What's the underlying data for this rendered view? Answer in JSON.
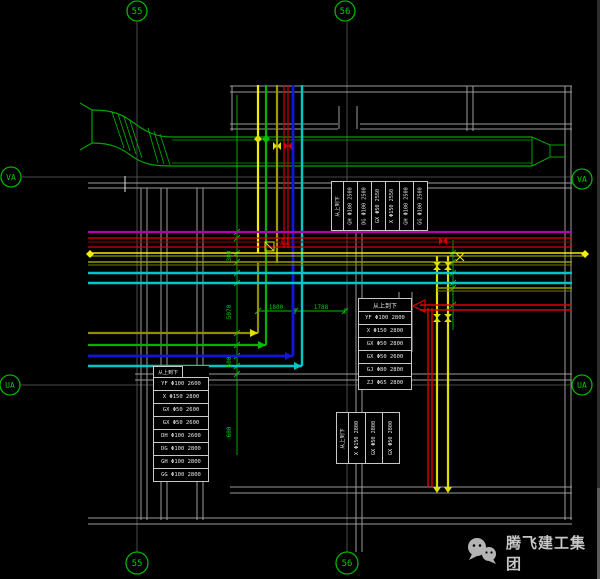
{
  "grid": {
    "col_a": "55",
    "col_b": "56",
    "row_a": "VA",
    "row_b": "UA"
  },
  "dims": {
    "h1": "1800",
    "h2": "1788",
    "v1": "5070",
    "v2": "300",
    "v3": "600",
    "v4": "600"
  },
  "tables": {
    "top_right": {
      "header": "从上到下",
      "cols": [
        "GH Φ100 2500",
        "DG Φ100 2500",
        "GX Φ50 2550",
        "X Φ150 2550",
        "GH Φ100 2500",
        "GG Φ100 2500"
      ]
    },
    "mid_right": {
      "header": "从上到下",
      "rows": [
        "YF Φ100 2800",
        "X Φ150 2800",
        "GX Φ50 2800",
        "GX Φ50 2600",
        "GJ Φ80 2800",
        "ZJ Φ65 2800"
      ]
    },
    "left": {
      "header": "从上到下",
      "rows": [
        "YF Φ100 2600",
        "X Φ150 2800",
        "GX Φ50 2600",
        "GX Φ50 2600",
        "DH Φ100 2600",
        "DG Φ100 2800",
        "GH Φ100 2800",
        "GG Φ100 2800"
      ]
    },
    "bottom_center": {
      "header": "从上到下",
      "cols": [
        "X Φ150 2800",
        "GX Φ50 2800",
        "GX Φ50 2800"
      ]
    }
  },
  "logo": {
    "text": "腾飞建工集团",
    "icon": "wechat-icon"
  },
  "colors": {
    "background": "#000000",
    "axis_green": "#00b400",
    "wall_gray": "#9c9c9c",
    "pipe_purple": "#b400b4",
    "pipe_red": "#e00000",
    "pipe_yellow": "#f0f000",
    "pipe_olive": "#9c9c00",
    "pipe_cyan": "#00c8c8",
    "pipe_blue": "#1414dc",
    "table_white": "#e8e8e8"
  }
}
